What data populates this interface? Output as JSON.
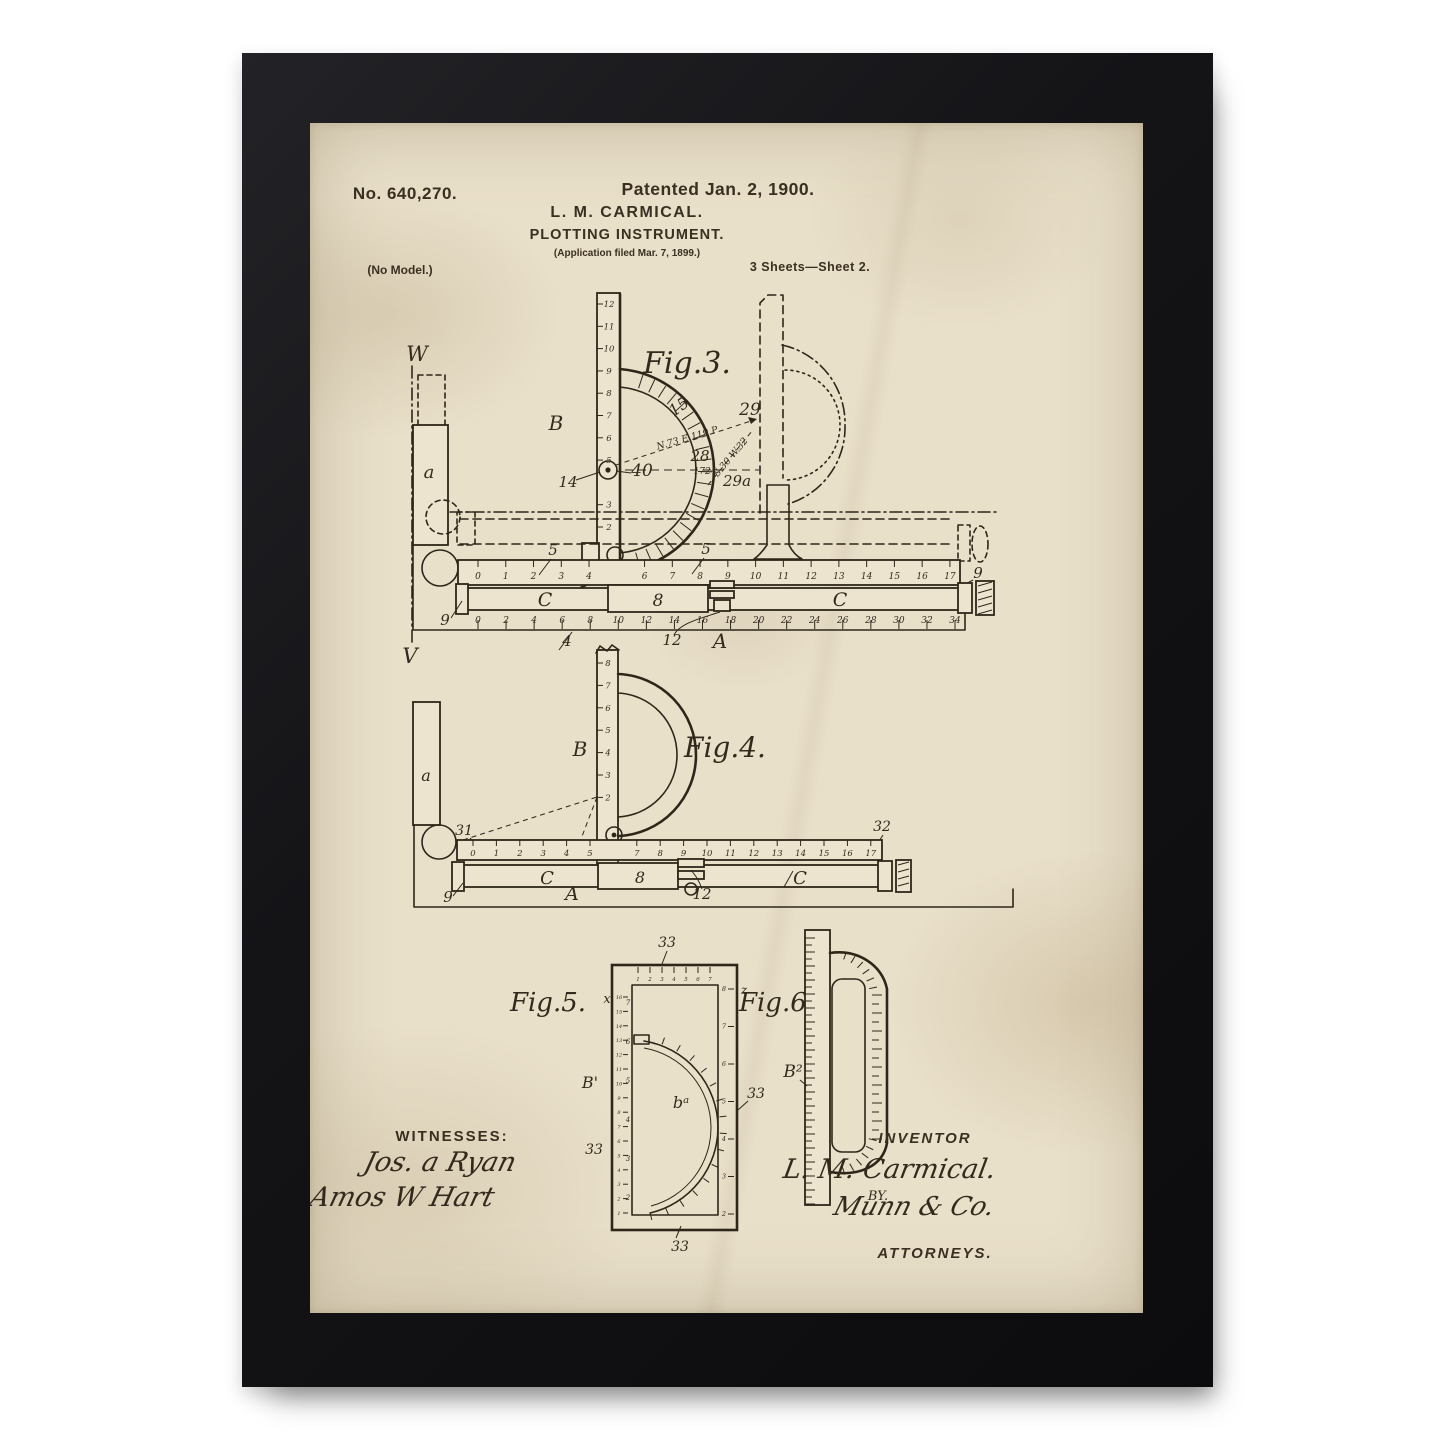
{
  "header": {
    "patent_number": "No. 640,270.",
    "patented": "Patented Jan. 2, 1900.",
    "inventor": "L. M. CARMICAL.",
    "title": "PLOTTING INSTRUMENT.",
    "application": "(Application filed Mar. 7, 1899.)",
    "no_model": "(No Model.)",
    "sheets": "3 Sheets—Sheet 2."
  },
  "fig3": {
    "caption": "Fig.3.",
    "labels": {
      "w": "W",
      "v": "V",
      "a": "a",
      "b": "B",
      "c_left": "C",
      "c_right": "C",
      "slider": "8",
      "frame": "A",
      "n14": "14",
      "n15": "15",
      "n40": "40",
      "n28": "28",
      "n29": "29",
      "n29a": "29a",
      "n1724": "1724",
      "n5_left": "5",
      "n5_right": "5",
      "n9_top": "9",
      "n9_bottom": "9",
      "n4": "4",
      "n12": "12"
    },
    "bearing1": "N.73 E.119.P",
    "bearing2": "S.30 W.32",
    "ruler_b_scale": [
      "12",
      "11",
      "10",
      "9",
      "8",
      "7",
      "6",
      "5",
      "",
      "3",
      "2"
    ],
    "top_scale": [
      "0",
      "1",
      "2",
      "3",
      "4",
      "",
      "6",
      "7",
      "8",
      "9",
      "10",
      "11",
      "12",
      "13",
      "14",
      "15",
      "16",
      "17"
    ],
    "bottom_scale": [
      "0",
      "2",
      "4",
      "6",
      "8",
      "10",
      "12",
      "14",
      "16",
      "18",
      "20",
      "22",
      "24",
      "26",
      "28",
      "30",
      "32",
      "34"
    ]
  },
  "fig4": {
    "caption": "Fig.4.",
    "labels": {
      "a": "a",
      "b": "B",
      "c_left": "C",
      "c_right": "C",
      "slider": "8",
      "frame": "A",
      "n31": "31",
      "n32": "32",
      "n9": "9",
      "n12": "12"
    },
    "ruler_b_scale": [
      "8",
      "7",
      "6",
      "5",
      "4",
      "3",
      "2"
    ],
    "top_scale": [
      "0",
      "1",
      "2",
      "3",
      "4",
      "5",
      "",
      "7",
      "8",
      "9",
      "10",
      "11",
      "12",
      "13",
      "14",
      "15",
      "16",
      "17"
    ]
  },
  "fig5": {
    "caption": "Fig.5.",
    "x_label": "x",
    "z_label": "z",
    "b_prime": "B'",
    "b_a": "bᵃ",
    "n33_top": "33",
    "n33_left": "33",
    "n33_right": "33",
    "n33_bottom": "33",
    "left_outer_scale": [
      "16",
      "15",
      "14",
      "13",
      "12",
      "11",
      "10",
      "9",
      "8",
      "7",
      "6",
      "5",
      "4",
      "3",
      "2",
      "1"
    ],
    "left_inner_scale": [
      "7",
      "6",
      "5",
      "4",
      "3",
      "2"
    ],
    "right_scale": [
      "8",
      "7",
      "6",
      "5",
      "4",
      "3",
      "2"
    ],
    "top_scale": [
      "1",
      "2",
      "3",
      "4",
      "5",
      "6",
      "7"
    ]
  },
  "fig6": {
    "caption": "Fig.6.",
    "b2": "B²"
  },
  "signatures": {
    "witnesses_label": "WITNESSES:",
    "witness1": "Jos. a Ryan",
    "witness2": "Amos W Hart",
    "inventor_label": "INVENTOR",
    "inventor_signature": "L. M. Carmical.",
    "by_label": "BY.",
    "attorney_signature": "Munn & Co.",
    "attorneys_label": "ATTORNEYS."
  }
}
